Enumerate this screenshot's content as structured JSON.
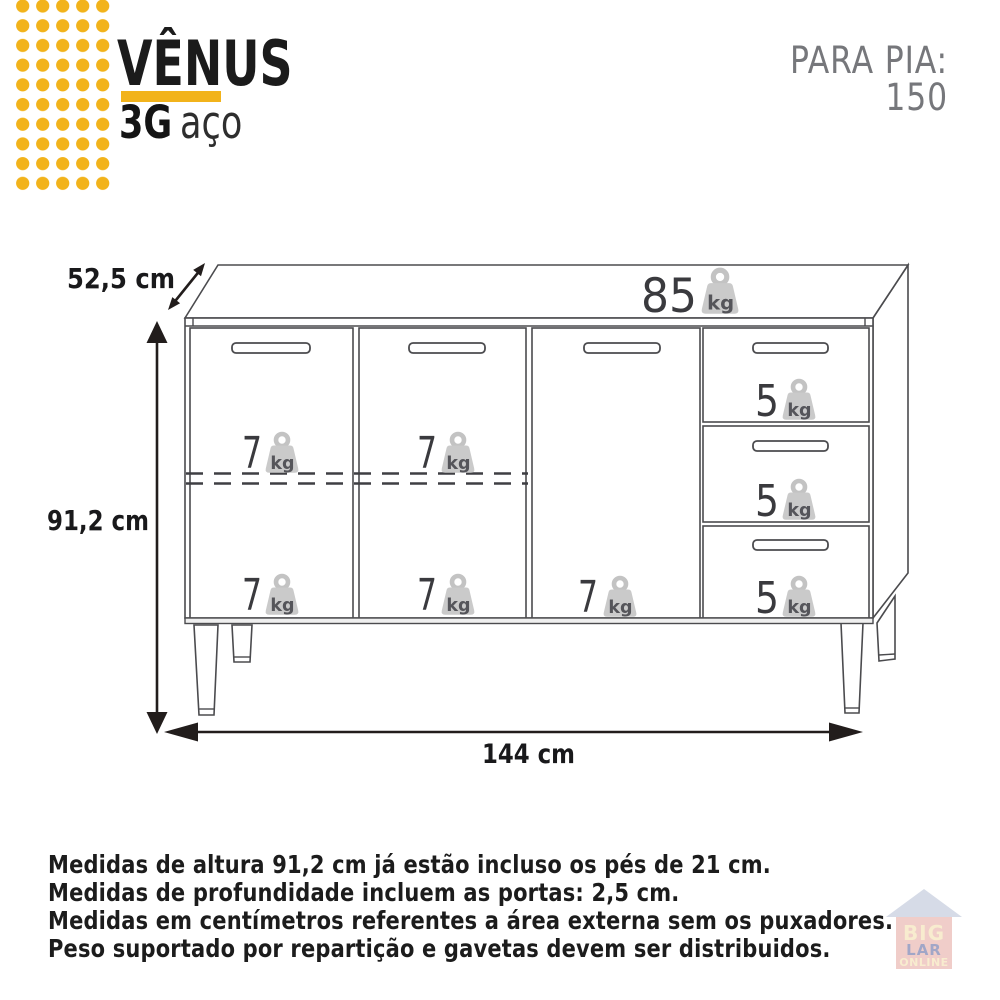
{
  "header": {
    "product": "VÊNUS",
    "series": "3G",
    "material": "aço",
    "sink_label": "PARA PIA:",
    "sink_value": "150"
  },
  "colors": {
    "accent_yellow": "#F2B31B",
    "muted_gray": "#76777B",
    "line_gray": "#4B4B4E",
    "number_gray": "#3A3A3E",
    "weight_icon_fill": "#CACACA",
    "weight_unit_gray": "#55555A"
  },
  "diagram": {
    "depth_label": "52,5 cm",
    "height_label": "91,2 cm",
    "width_label": "144 cm",
    "unit_kg": "kg",
    "top_capacity": "85",
    "door1_top": "7",
    "door2_top": "7",
    "door1_bottom": "7",
    "door2_bottom": "7",
    "door3_bottom": "7",
    "drawer1": "5",
    "drawer2": "5",
    "drawer3": "5"
  },
  "footnotes": [
    "Medidas de altura 91,2 cm já estão incluso os pés de 21 cm.",
    "Medidas de profundidade incluem as portas: 2,5 cm.",
    "Medidas em centímetros referentes a área externa sem os puxadores.",
    "Peso suportado por repartição e gavetas devem ser distribuidos."
  ],
  "watermark": {
    "line1": "BIG",
    "line2": "LAR",
    "line3": "ONLINE"
  }
}
